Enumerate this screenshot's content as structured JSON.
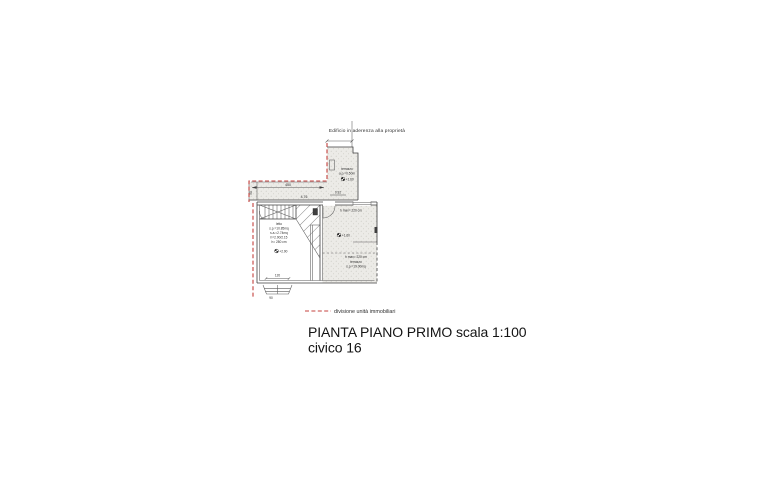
{
  "title": {
    "line1": "PIANTA PIANO PRIMO scala 1:100",
    "line2": "civico 16"
  },
  "legend": {
    "text": "divisione unità immobiliari"
  },
  "colors": {
    "division_line_red": "#c4403c",
    "drawing_line": "#3f3f3f",
    "hatch_fill": "#ecebe7"
  },
  "plan": {
    "adjacency_note": "Edificio in aderenza alla proprietà",
    "upper_terrace": {
      "name": "terrazzo",
      "parapet": "a.p.=0.50m",
      "level": "+1.60"
    },
    "strip": {
      "dim_top": "450",
      "dim_mid": "4.76",
      "dim_left": "90"
    },
    "door_dim": "0.92",
    "letto": {
      "name": "letto",
      "area1": "s.p.=10.85mq",
      "area2": "s.a.=2.74mq",
      "height1": "h=2.90/2.15",
      "height2": "h= 280 cm",
      "level": "+2.90",
      "dim_width": "120",
      "bay_dim": "90"
    },
    "right_room": {
      "hmax_upper": "h max= 220 cm",
      "level": "+1.60",
      "hmax_lower": "h max= 220 cm",
      "name": "terrazzo",
      "area": "s.p.=19.00mq"
    }
  }
}
